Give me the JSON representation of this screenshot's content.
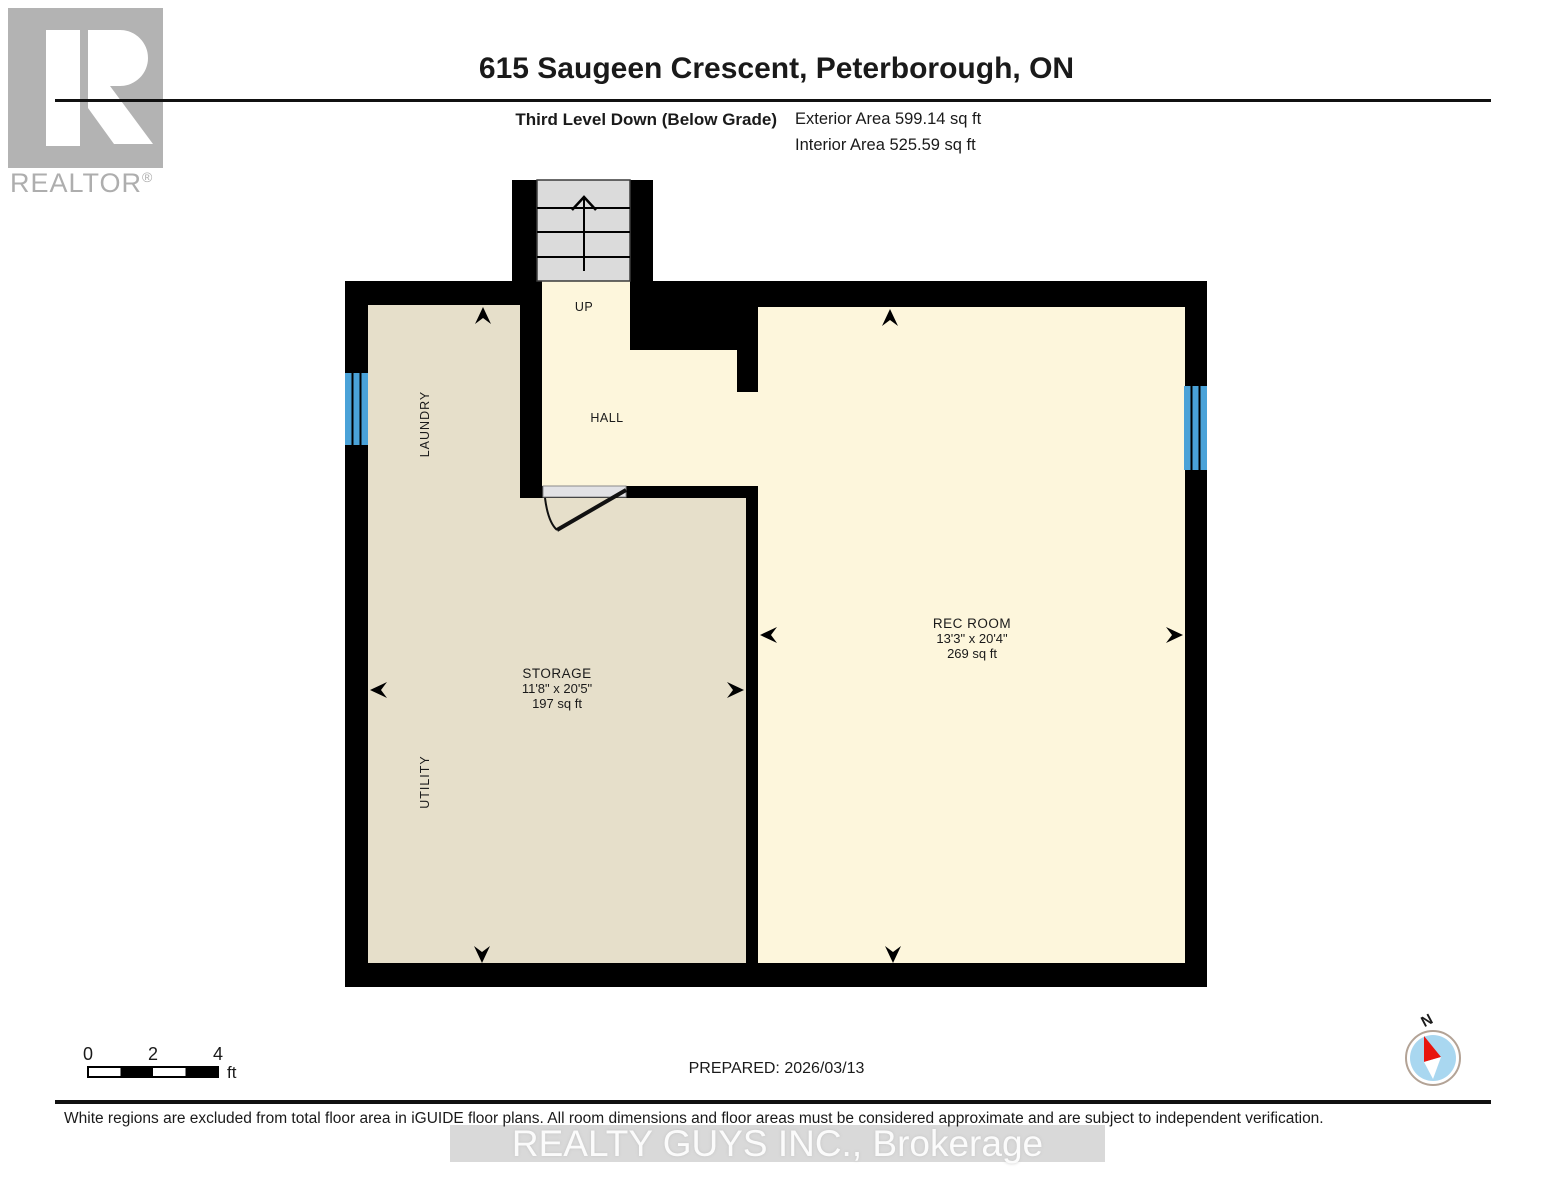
{
  "header": {
    "logo_text": "REALTOR",
    "logo_reg": "®",
    "title": "615 Saugeen Crescent, Peterborough, ON",
    "level_label": "Third Level Down (Below Grade)",
    "exterior_area": "Exterior Area 599.14 sq ft",
    "interior_area": "Interior Area 525.59 sq ft"
  },
  "floor_plan": {
    "labels": {
      "up": "UP",
      "hall": "HALL",
      "laundry": "LAUNDRY",
      "utility": "UTILITY"
    },
    "rooms": {
      "storage": {
        "name": "STORAGE",
        "dimensions": "11'8\" x 20'5\"",
        "area": "197 sq ft"
      },
      "rec_room": {
        "name": "REC ROOM",
        "dimensions": "13'3\" x 20'4\"",
        "area": "269 sq ft"
      }
    },
    "colors": {
      "wall": "#000000",
      "storage_floor": "#e6dfca",
      "hall_rec_floor": "#fdf6dc",
      "stairs": "#dbdbdb",
      "window": "#4aa2d8",
      "door_threshold": "#e2e2e5"
    }
  },
  "scale_bar": {
    "labels": [
      "0",
      "2",
      "4"
    ],
    "unit": "ft"
  },
  "footer": {
    "prepared": "PREPARED: 2026/03/13",
    "compass_label": "N",
    "disclaimer": "White regions are excluded from total floor area in iGUIDE floor plans. All room dimensions and floor areas must be considered approximate and are subject to independent verification.",
    "watermark": "REALTY GUYS INC., Brokerage"
  }
}
